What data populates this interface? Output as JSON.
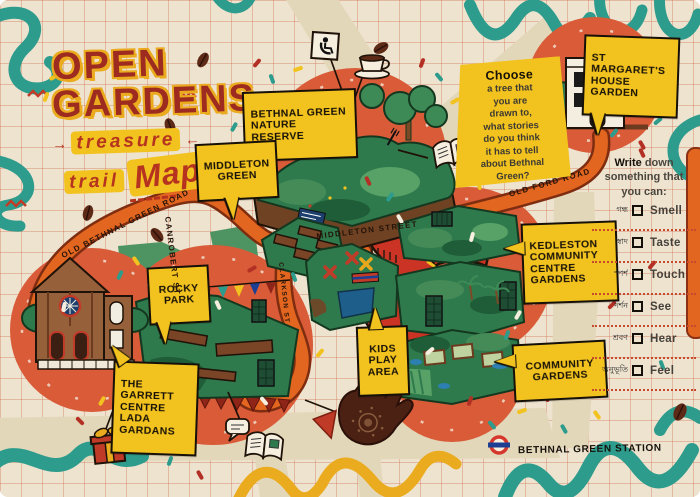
{
  "title": {
    "line1": "OPEN",
    "line2": "GARDENS",
    "word_treasure": "treasure",
    "word_trail": "trail",
    "word_map": "Map",
    "arrow_right": "→",
    "arrow_left": "←"
  },
  "labels": {
    "nature_reserve": "BETHNAL GREEN\nNATURE RESERVE",
    "middleton_green": "MIDDLETON\nGREEN",
    "st_margarets": "ST MARGARET'S\nHOUSE GARDEN",
    "kedleston": "KEDLESTON\nCOMMUNITY\nCENTRE\nGARDENS",
    "rocky_park": "ROCKY\nPARK",
    "kids_play_area": "KIDS\nPLAY\nAREA",
    "community_gardens": "COMMUNITY\nGARDENS",
    "garrett_centre": "THE GARRETT\nCENTRE\nLADA\nGARDANS"
  },
  "streets": {
    "old_bethnal": "OLD BETHNAL GREEN ROAD",
    "canrobert": "CANROBERT ST",
    "middleton": "MIDDLETON STREET",
    "old_ford": "OLD FORD ROAD",
    "clarkson": "CLARKSON ST"
  },
  "station": {
    "name": "BETHNAL GREEN STATION"
  },
  "choose_box": {
    "bold": "Choose",
    "rest": "a tree that\nyou are\ndrawn to,\nwhat stories\ndo you think\nit has to tell\nabout Bethnal\nGreen?"
  },
  "write_prompt": {
    "bold": "Write",
    "line1_rest": " down",
    "line2": "something that",
    "line3": "you can:"
  },
  "senses": [
    {
      "bn": "গন্ধ",
      "en": "Smell"
    },
    {
      "bn": "স্বাদ",
      "en": "Taste"
    },
    {
      "bn": "স্পর্শ",
      "en": "Touch"
    },
    {
      "bn": "দর্শন",
      "en": "See"
    },
    {
      "bn": "শ্রবণ",
      "en": "Hear"
    },
    {
      "bn": "অনুভূতি",
      "en": "Feel"
    }
  ],
  "icons": {
    "wheelchair": "wheelchair-accessible",
    "coffee": "coffee-cup",
    "leaflet": "leaflet-booklet",
    "speech": "speech-bubble",
    "gift": "gift-box",
    "hand": "henna-hand",
    "roundel": "underground-roundel",
    "fork": "fork"
  },
  "colors": {
    "cream": "#EDE3CF",
    "trail_orange": "#E2661F",
    "trail_edge": "#7F2D10",
    "map_red_circle": "#D95B38",
    "path_red": "#CB3424",
    "label_yellow": "#F2C21E",
    "green_dark": "#2F7A4C",
    "teal": "#2E9C8C",
    "accent_red": "#C23B28",
    "roundel_red": "#D6372C",
    "roundel_blue": "#1C3F94"
  }
}
